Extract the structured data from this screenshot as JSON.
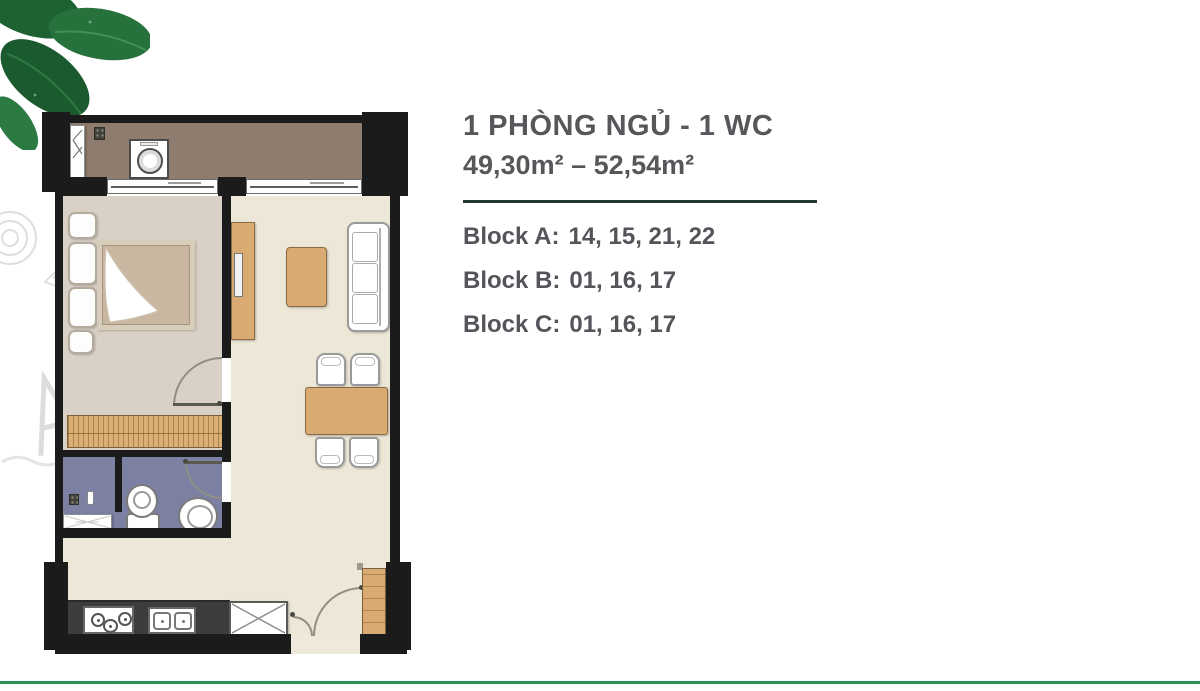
{
  "page": {
    "background": "#ffffff"
  },
  "info": {
    "title": "1 PHÒNG NGỦ - 1 WC",
    "area_range": "49,30m² – 52,54m²",
    "blocks": [
      {
        "label": "Block A:",
        "units": "14, 15, 21, 22"
      },
      {
        "label": "Block B:",
        "units": "01, 16, 17"
      },
      {
        "label": "Block C:",
        "units": "01, 16, 17"
      }
    ],
    "text_color": "#56575a",
    "divider_color": "#223630"
  },
  "floorplan": {
    "wall_color": "#1b1b1b",
    "rooms": [
      {
        "name": "balcony",
        "floor_color": "#8e7d6f"
      },
      {
        "name": "bedroom",
        "floor_color": "#d9d0c6"
      },
      {
        "name": "living-dining",
        "floor_color": "#ede7d7"
      },
      {
        "name": "bathroom",
        "floor_color": "#7c80a2"
      },
      {
        "name": "kitchen-entry",
        "floor_color": "#ede7d7"
      }
    ],
    "furniture_icons": [
      "washing-machine-icon",
      "balcony-drain-icon",
      "louver-window-icon",
      "double-bed-icon",
      "pillow-icon",
      "blanket-icon",
      "wardrobe-icon",
      "bedroom-door-arc-icon",
      "sliding-glass-door-icon",
      "tv-console-icon",
      "tv-icon",
      "coffee-table-icon",
      "sofa-icon",
      "dining-table-icon",
      "dining-chair-icon",
      "shower-drain-icon",
      "toiletries-bottle-icon",
      "bath-mat-icon",
      "toilet-icon",
      "round-sink-icon",
      "bathroom-door-arc-icon",
      "gas-stove-icon",
      "kitchen-sink-icon",
      "fridge-icon",
      "entry-door-arc-icon",
      "shoe-cabinet-icon"
    ],
    "wood_color": "#d9ab72",
    "counter_color": "#3d3d3d"
  },
  "decoration": {
    "leaf_icon": "mint-leaves",
    "leaf_color": "#1e6132",
    "sketch_color": "#dcdcdc",
    "accent_line_color": "#2e9157"
  }
}
